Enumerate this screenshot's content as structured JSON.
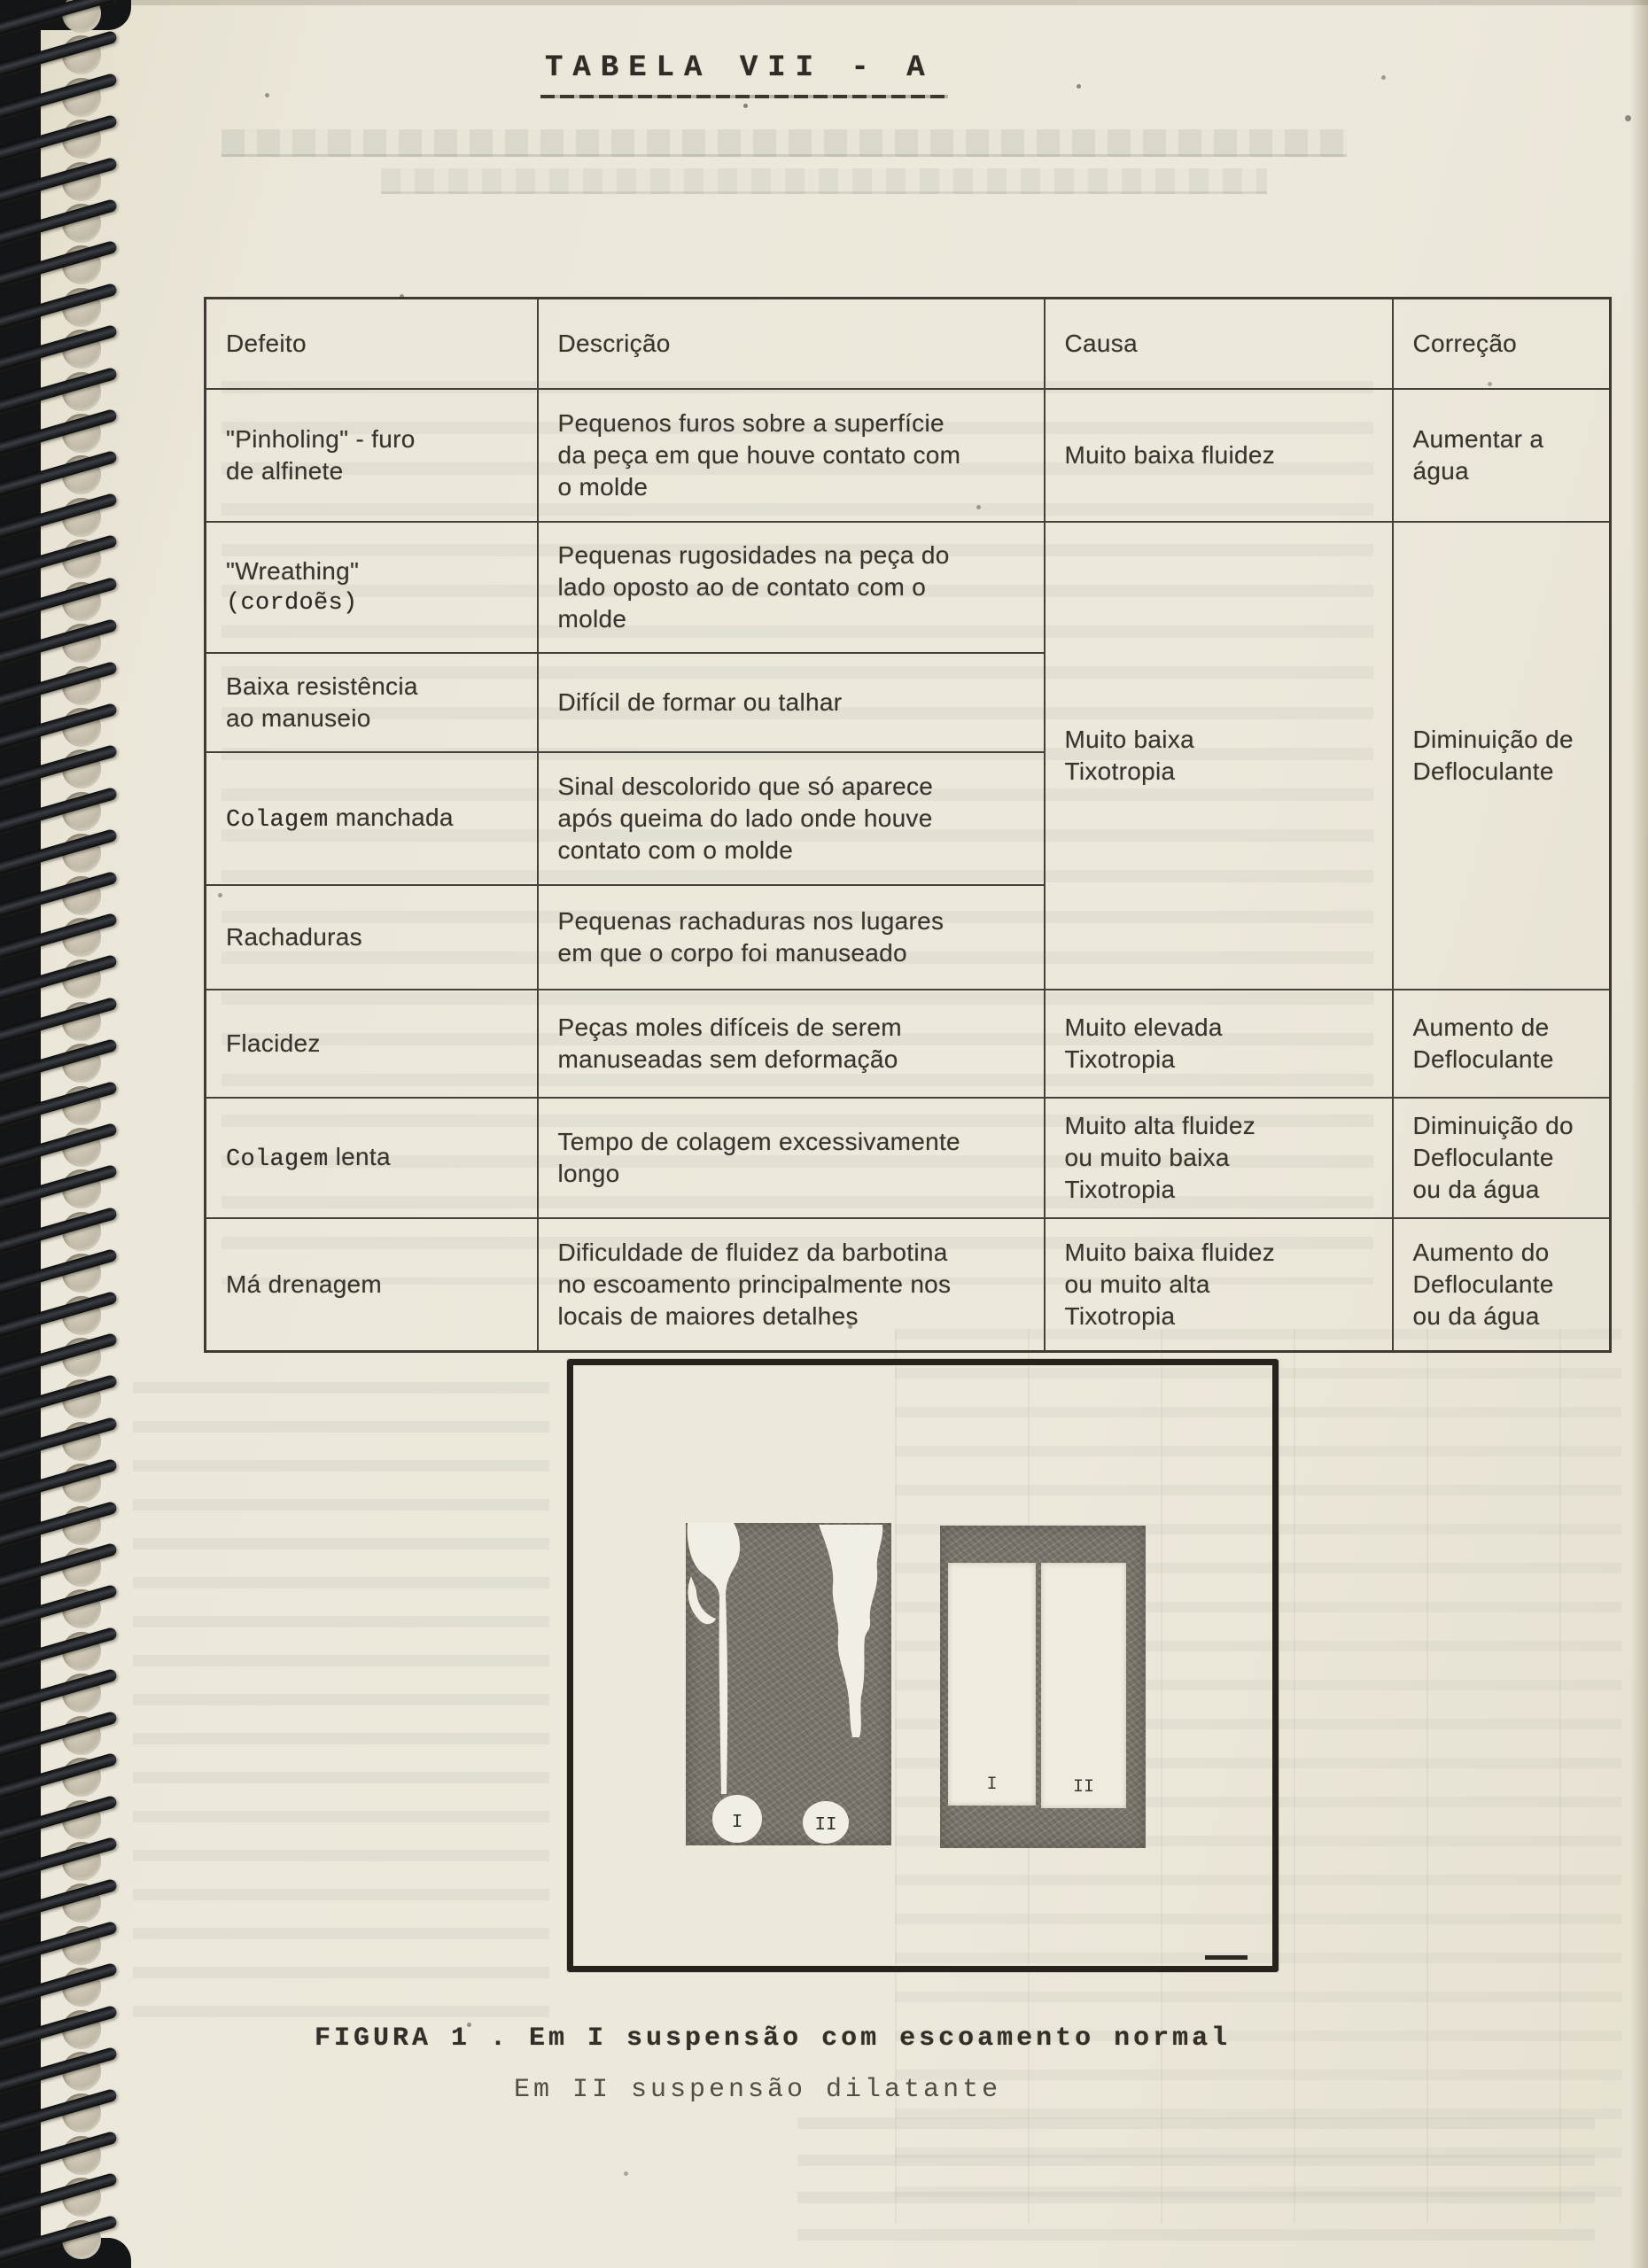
{
  "page_title": "TABELA VII - A",
  "table": {
    "headers": [
      "Defeito",
      "Descrição",
      "Causa",
      "Correção"
    ],
    "rows": [
      {
        "defeito": [
          "\"Pinholing\" - furo",
          "de alfinete"
        ],
        "descricao": [
          "Pequenos furos sobre a superfície",
          "da peça em que houve contato com",
          "o molde"
        ],
        "causa": [
          "Muito baixa fluidez"
        ],
        "correcao": [
          "Aumentar a",
          "água"
        ]
      },
      {
        "defeito_line1": "\"Wreathing\"",
        "defeito_line2_typed": "(cordoẽs)",
        "descricao": [
          "Pequenas rugosidades na peça do",
          "lado oposto ao de contato com o",
          "molde"
        ],
        "causa_merged": [
          "Muito baixa",
          "Tixotropia"
        ],
        "correcao_merged": [
          "Diminuição de",
          "Defloculante"
        ]
      },
      {
        "defeito": [
          "Baixa resistência",
          "ao manuseio"
        ],
        "descricao": [
          "Difícil de formar ou talhar"
        ]
      },
      {
        "defeito_typed": "Colagem",
        "defeito_rest": " manchada",
        "descricao": [
          "Sinal descolorido que só aparece",
          "após queima do lado onde houve",
          "contato com o molde"
        ]
      },
      {
        "defeito": [
          "Rachaduras"
        ],
        "descricao": [
          "Pequenas rachaduras nos lugares",
          "em que o corpo foi manuseado"
        ]
      },
      {
        "defeito": [
          "Flacidez"
        ],
        "descricao": [
          "Peças moles difíceis de serem",
          "manuseadas sem deformação"
        ],
        "causa": [
          "Muito elevada",
          "Tixotropia"
        ],
        "correcao": [
          "Aumento de",
          "Defloculante"
        ]
      },
      {
        "defeito_typed": "Colagem",
        "defeito_rest": " lenta",
        "descricao": [
          "Tempo de colagem excessivamente",
          "longo"
        ],
        "causa": [
          "Muito alta fluidez",
          "ou muito baixa",
          "Tixotropia"
        ],
        "correcao": [
          "Diminuição do",
          "Defloculante",
          "ou da água"
        ]
      },
      {
        "defeito": [
          "Má drenagem"
        ],
        "descricao": [
          "Dificuldade de fluidez da barbotina",
          "no escoamento principalmente nos",
          "locais de maiores detalhes"
        ],
        "causa": [
          "Muito baixa fluidez",
          "ou muito alta",
          "Tixotropia"
        ],
        "correcao": [
          "Aumento do",
          "Defloculante",
          "ou da água"
        ]
      }
    ]
  },
  "figure": {
    "left_panel_labels": {
      "stream_i": "I",
      "stream_ii": "II"
    },
    "right_panel_labels": {
      "slot_i": "I",
      "slot_ii": "II"
    },
    "caption_line1": "FIGURA 1 . Em I suspensão com escoamento normal",
    "caption_line2": "Em II suspensão dilatante"
  },
  "colors": {
    "paper": "#ebe7da",
    "ink": "#38352e",
    "coil_black": "#141516",
    "figure_panel_gray": "#7b766c"
  }
}
